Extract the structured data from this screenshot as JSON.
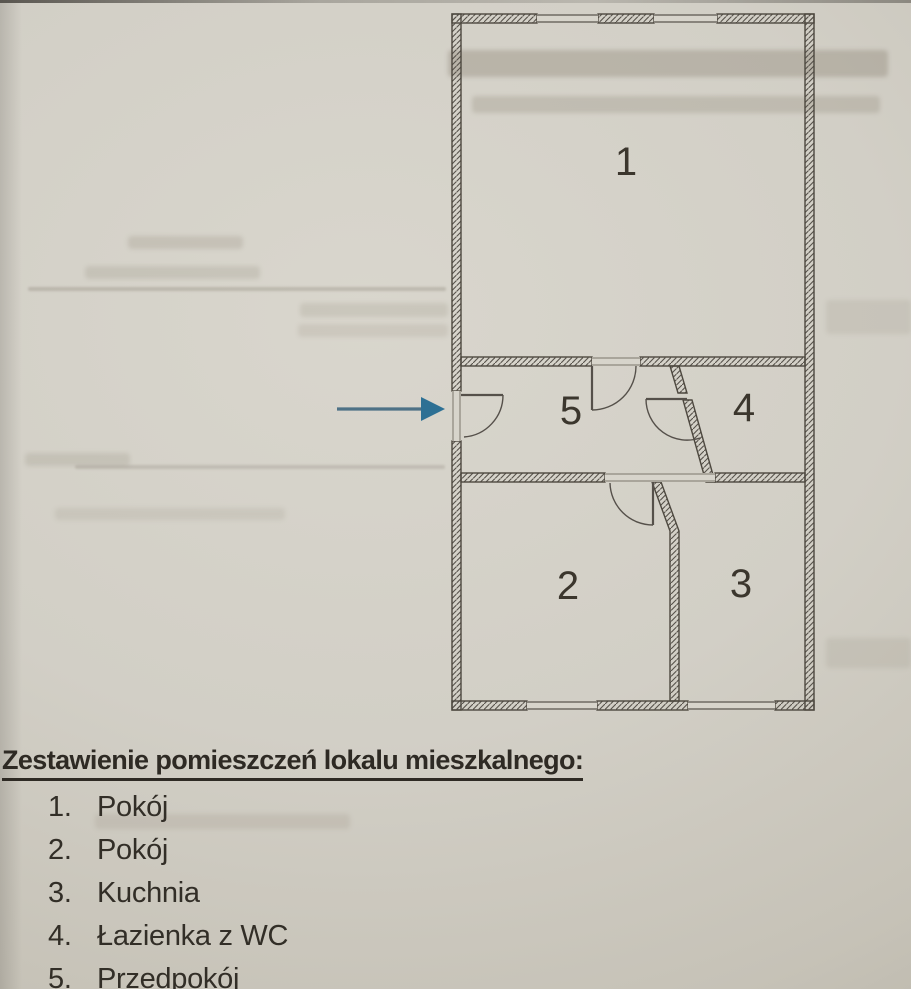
{
  "floor_plan": {
    "labels": [
      "1",
      "2",
      "3",
      "4",
      "5"
    ],
    "colors": {
      "wall_ink": "#4d483f",
      "arrow_head": "#2d7094",
      "arrow_shaft": "#4e7186",
      "paper": "#d2cfc6",
      "text_ink": "#322e27"
    }
  },
  "legend": {
    "heading": "Zestawienie pomieszczeń lokalu mieszkalnego:",
    "items": [
      {
        "num": "1.",
        "label": "Pokój"
      },
      {
        "num": "2.",
        "label": "Pokój"
      },
      {
        "num": "3.",
        "label": "Kuchnia"
      },
      {
        "num": "4.",
        "label": "Łazienka z WC"
      },
      {
        "num": "5.",
        "label": "Przedpokój"
      }
    ]
  }
}
